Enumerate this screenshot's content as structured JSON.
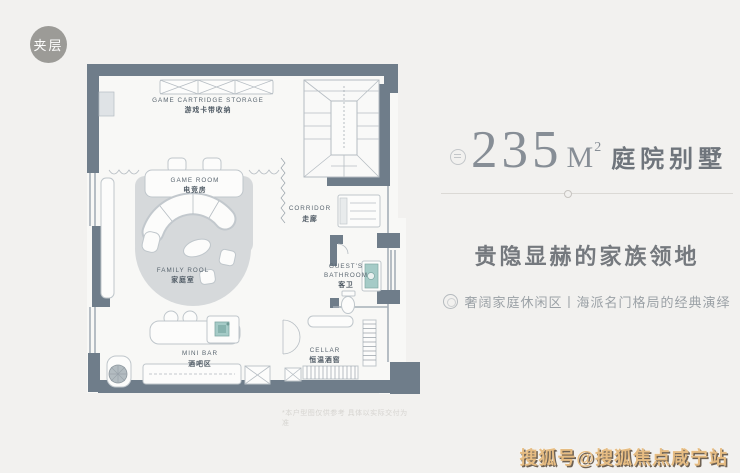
{
  "page": {
    "bg": "#f2f1ef"
  },
  "badge": {
    "label": "夹层"
  },
  "floorplan": {
    "rooms": {
      "storage": {
        "en": "GAME CARTRIDGE STORAGE",
        "zh": "游戏卡带收纳"
      },
      "game_room": {
        "en": "GAME ROOM",
        "zh": "电竞房"
      },
      "family_room": {
        "en": "FAMILY ROOL",
        "zh": "家庭室"
      },
      "corridor": {
        "en": "CORRIDOR",
        "zh": "走廊"
      },
      "guest_bathroom": {
        "en_line1": "GUEST'S",
        "en_line2": "BATHROOM",
        "zh": "客卫"
      },
      "cellar": {
        "en": "CELLAR",
        "zh": "恒温酒窖"
      },
      "mini_bar": {
        "en": "MINI BAR",
        "zh": "酒吧区"
      }
    },
    "disclaimer": "*本户型图仅供参考 具体以实际交付为准"
  },
  "info": {
    "area_value": "235",
    "area_unit": "M",
    "area_exponent": "2",
    "title_suffix": "庭院别墅",
    "headline": "贵隐显赫的家族领地",
    "subline": "奢阔家庭休闲区丨海派名门格局的经典演绎"
  },
  "watermark": {
    "text": "搜狐号@搜狐焦点咸宁站"
  },
  "colors": {
    "wall": "#6f7d8a",
    "accent_teal": "#a5cbc7",
    "title_gray": "#878e96",
    "watermark_orange": "#e6bc82"
  }
}
